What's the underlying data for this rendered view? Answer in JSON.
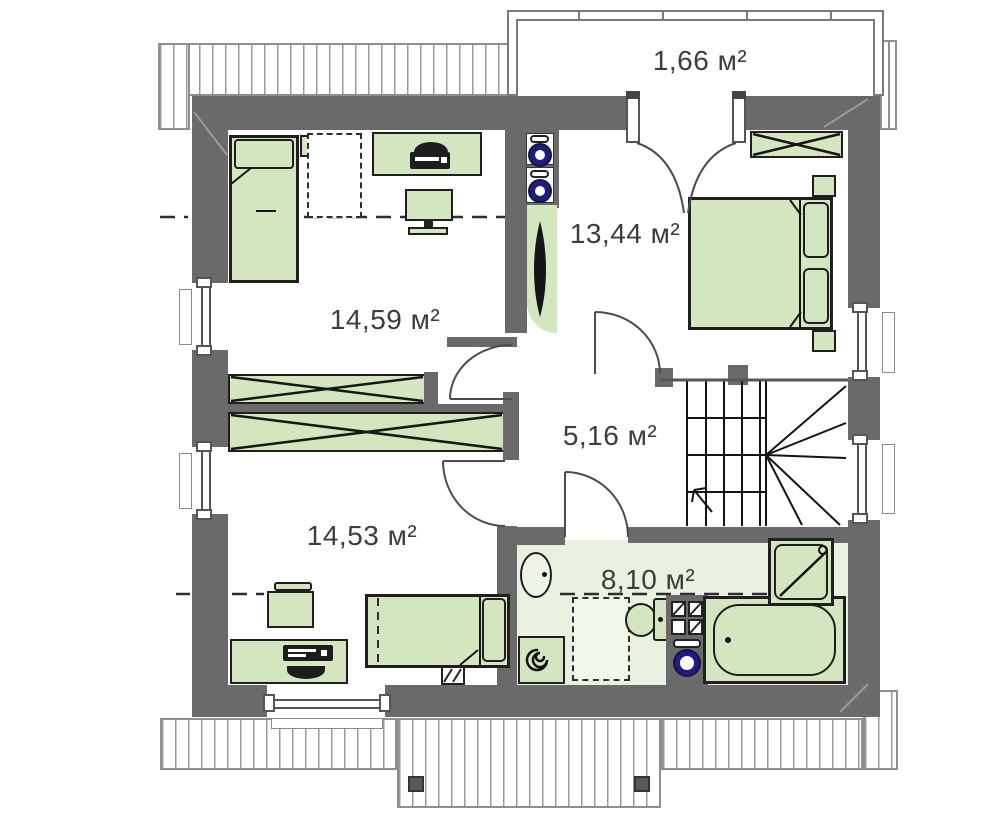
{
  "plan": {
    "type": "floor-plan-attic-storey",
    "rooms": [
      {
        "name": "balcony",
        "area": "1,66 м²"
      },
      {
        "name": "bedroom",
        "area": "13,44 м²"
      },
      {
        "name": "room-top-left",
        "area": "14,59 м²"
      },
      {
        "name": "hallway",
        "area": "5,16 м²"
      },
      {
        "name": "room-bottom-left",
        "area": "14,53 м²"
      },
      {
        "name": "bathroom",
        "area": "8,10 м²"
      }
    ],
    "colors": {
      "wall": "#6a6a6a",
      "furniture_fill": "#d3e6bf",
      "bathroom_floor": "#e9f1e0",
      "flue_ring": "#1e1e82",
      "outline": "#1a1a1a",
      "roof_stripe": "#9b9b9b"
    },
    "fixtures": [
      "double-bed",
      "single-bed",
      "wardrobe",
      "desk",
      "tv",
      "chair",
      "computer",
      "printer",
      "sink",
      "toilet",
      "bathtub",
      "shower",
      "water-heater",
      "plant",
      "stairs",
      "chimney-flues",
      "skylight",
      "windows",
      "doors",
      "balcony-railing"
    ]
  }
}
